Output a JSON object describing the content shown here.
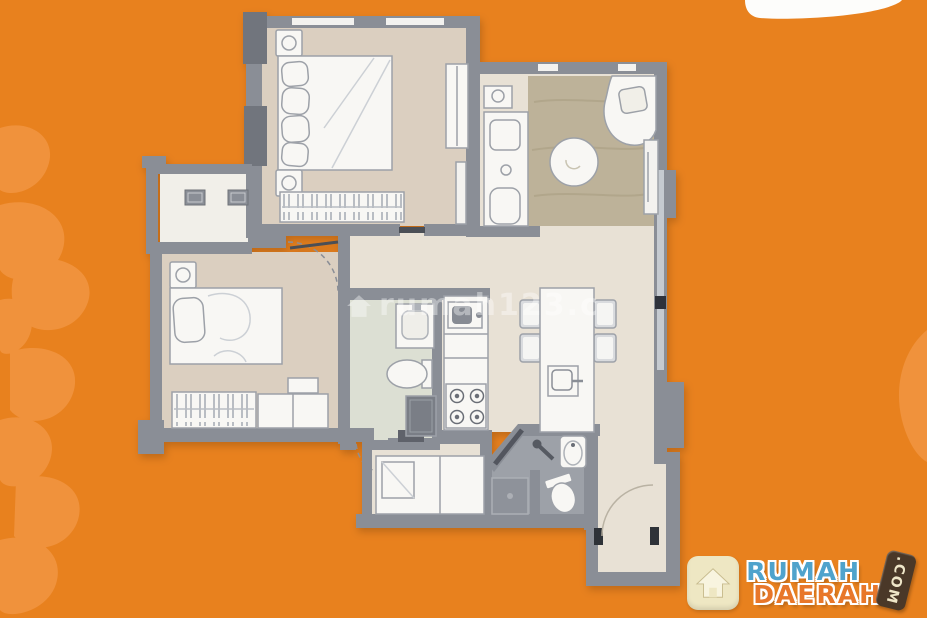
{
  "background": {
    "base_color": "#E8811E",
    "swirl_color": "#F0923C",
    "swoosh_color": "#FDFDFB"
  },
  "floorplan": {
    "palette": {
      "wall": "#8A8E96",
      "wall_dark": "#71757D",
      "bedroom_floor": "#DBCFC0",
      "hall_floor": "#E8E1D5",
      "bathroom_floor": "#DCDFD3",
      "wet_bathroom_floor": "#9DA1A8",
      "wood_floor": "#BDB299",
      "furniture_fill": "#F8F7F4",
      "furniture_outline": "#9DA1A8"
    }
  },
  "watermark": {
    "icon": "home-icon",
    "text": "rumah123.c"
  },
  "logo": {
    "icon": "home-icon",
    "title_top": "RUMAH",
    "title_bottom": "DAERAH",
    "tag": ".COM",
    "title_top_color": "#4FA3CC",
    "title_bottom_color": "#E8772A",
    "tag_bg_color": "#4A3828",
    "icon_bg_color": "#EEE7C3"
  }
}
